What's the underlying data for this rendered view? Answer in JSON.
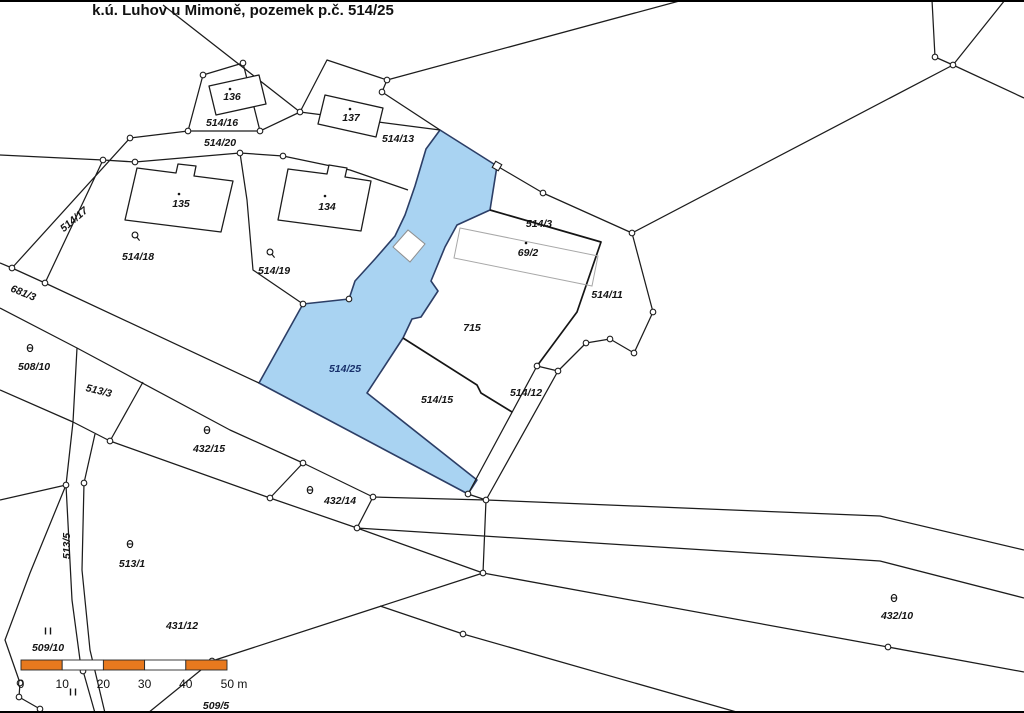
{
  "title": "k.ú. Luhov u Mimoně, pozemek p.č. 514/25",
  "highlighted_parcel": "514/25",
  "colors": {
    "highlight_fill": "#a9d3f2",
    "highlight_label": "#18306b",
    "label": "#141414",
    "line": "#1c1c1c",
    "scale_orange": "#e8791e"
  },
  "labels": [
    {
      "t": "136",
      "x": 232,
      "y": 100
    },
    {
      "t": "514/16",
      "x": 222,
      "y": 126
    },
    {
      "t": "514/20",
      "x": 220,
      "y": 146
    },
    {
      "t": "137",
      "x": 351,
      "y": 121
    },
    {
      "t": "514/13",
      "x": 398,
      "y": 142
    },
    {
      "t": "135",
      "x": 181,
      "y": 207
    },
    {
      "t": "134",
      "x": 327,
      "y": 210
    },
    {
      "t": "514/17",
      "x": 76,
      "y": 222,
      "r": -40
    },
    {
      "t": "514/18",
      "x": 138,
      "y": 260
    },
    {
      "t": "514/19",
      "x": 274,
      "y": 274
    },
    {
      "t": "514/3",
      "x": 539,
      "y": 227
    },
    {
      "t": "69/2",
      "x": 528,
      "y": 256
    },
    {
      "t": "514/11",
      "x": 607,
      "y": 298
    },
    {
      "t": "715",
      "x": 472,
      "y": 331
    },
    {
      "t": "514/25",
      "x": 345,
      "y": 372,
      "c": "b"
    },
    {
      "t": "514/15",
      "x": 437,
      "y": 403
    },
    {
      "t": "514/12",
      "x": 526,
      "y": 396
    },
    {
      "t": "681/3",
      "x": 22,
      "y": 296,
      "r": 22
    },
    {
      "t": "508/10",
      "x": 34,
      "y": 370
    },
    {
      "t": "513/3",
      "x": 98,
      "y": 394,
      "r": 14
    },
    {
      "t": "432/15",
      "x": 209,
      "y": 452
    },
    {
      "t": "432/14",
      "x": 340,
      "y": 504
    },
    {
      "t": "513/5",
      "x": 70,
      "y": 546,
      "r": -90
    },
    {
      "t": "513/1",
      "x": 132,
      "y": 567
    },
    {
      "t": "431/12",
      "x": 182,
      "y": 629
    },
    {
      "t": "509/10",
      "x": 48,
      "y": 651
    },
    {
      "t": "509/5",
      "x": 216,
      "y": 709,
      "s": 9
    },
    {
      "t": "432/10",
      "x": 897,
      "y": 619
    }
  ],
  "dots": [
    [
      230,
      89
    ],
    [
      350,
      109
    ],
    [
      179,
      194
    ],
    [
      325,
      196
    ],
    [
      526,
      243
    ]
  ],
  "symbols": [
    {
      "k": "theta",
      "x": 30,
      "y": 348
    },
    {
      "k": "theta",
      "x": 207,
      "y": 430
    },
    {
      "k": "theta",
      "x": 310,
      "y": 490
    },
    {
      "k": "theta",
      "x": 130,
      "y": 544
    },
    {
      "k": "theta",
      "x": 894,
      "y": 598
    },
    {
      "k": "ring",
      "x": 135,
      "y": 235
    },
    {
      "k": "ring",
      "x": 270,
      "y": 252
    },
    {
      "k": "bars",
      "x": 48,
      "y": 631
    },
    {
      "k": "bars",
      "x": 73,
      "y": 692
    }
  ],
  "scalebar": {
    "x0": 21,
    "y": 660,
    "h": 10,
    "seg": 41.2,
    "ticks": [
      "0",
      "10",
      "20",
      "30",
      "40",
      "50 m"
    ],
    "label_y": 688
  }
}
